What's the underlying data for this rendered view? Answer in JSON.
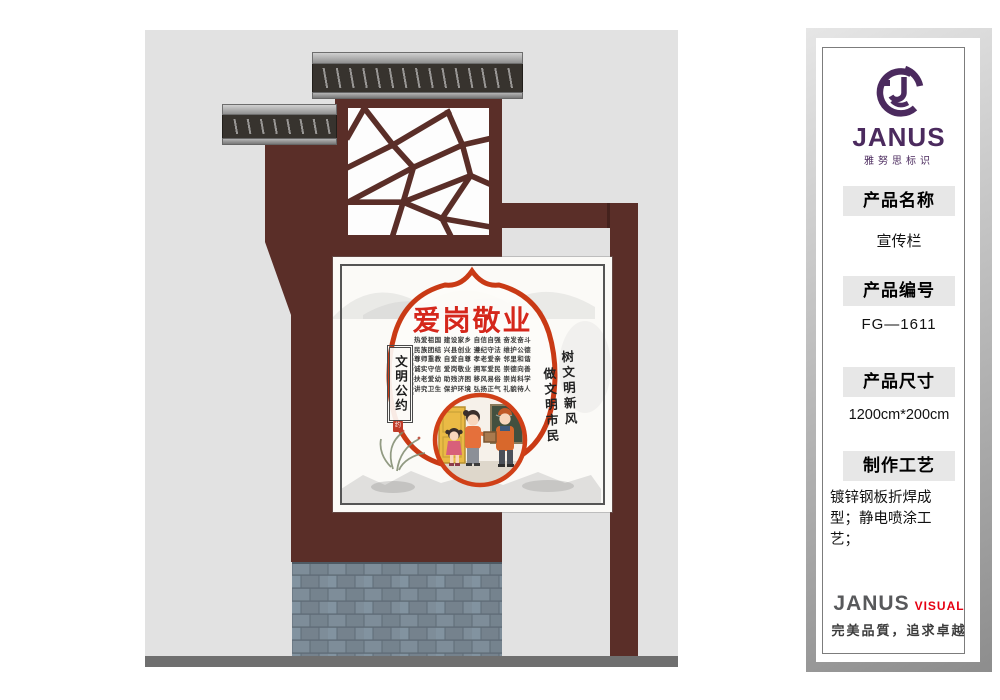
{
  "panel": {
    "logo": {
      "brand": "JANUS",
      "subtitle": "雅努思标识"
    },
    "fields": [
      {
        "label": "产品名称",
        "value": "宣传栏"
      },
      {
        "label": "产品编号",
        "value": "FG—1611"
      },
      {
        "label": "产品尺寸",
        "value": "1200cm*200cm"
      },
      {
        "label": "制作工艺",
        "value": "镀锌钢板折焊成型；静电喷涂工艺；"
      }
    ],
    "footer": {
      "brand": "JANUS",
      "suffix": "VISUAL",
      "slogan": "完美品質，追求卓越"
    }
  },
  "poster": {
    "title": "爱岗敬业",
    "rows": [
      "热爱祖国 建设家乡 自信自强 奋发奋斗",
      "民族团结 兴县创业 遵纪守法 维护公德",
      "尊师重教 自爱自尊 孝老爱亲 邻里和谐",
      "诚实守信 爱岗敬业 拥军爱民 崇德向善",
      "扶老爱幼 助残济困 移风易俗 崇尚科学",
      "讲究卫生 保护环境 弘扬正气 礼貌待人"
    ],
    "plaque": "文明公约",
    "seal": "约",
    "calligraphy": [
      "树文明新风",
      "做文明市民"
    ]
  },
  "colors": {
    "maroon": "#5a2e28",
    "poster_red": "#c93a15",
    "title_red": "#d5271b",
    "logo_purple": "#4b2a5e",
    "visual_red": "#e60012",
    "brick": "#7c8a96",
    "stage_bg": "#e2e2e2"
  }
}
